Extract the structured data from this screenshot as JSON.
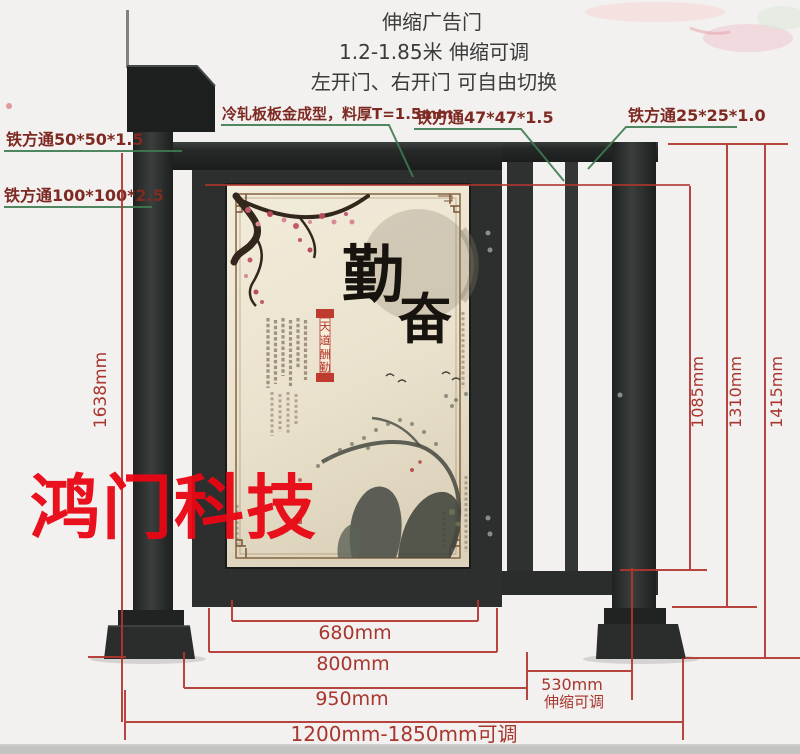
{
  "title": {
    "line1": "伸缩广告门",
    "line2": "1.2-1.85米 伸缩可调",
    "line3": "左开门、右开门 可自由切换"
  },
  "callouts": {
    "tube_50": "铁方通50*50*1.5",
    "tube_100": "铁方通100*100*2.5",
    "cold_rolled_plate": "冷轧板板金成型，料厚T=1.5mm",
    "tube_47": "铁方通47*47*1.5",
    "tube_25": "铁方通25*25*1.0"
  },
  "dimensions": {
    "post_height": "1638mm",
    "door_opening_height": "1085mm",
    "frame_height": "1310mm",
    "overall_height": "1415mm",
    "poster_width": "680mm",
    "door_width": "800mm",
    "door_section_width": "950mm",
    "telescopic_width": "530mm",
    "telescopic_note": "伸缩可调",
    "overall_width": "1200mm-1850mm可调"
  },
  "watermark": "鸿门科技",
  "poster": {
    "char_top": "勤",
    "char_bottom": "奋",
    "seal_chars": [
      "天",
      "道",
      "酬",
      "勤"
    ]
  },
  "colors": {
    "dimension_red": "#b2362f",
    "callout_green": "#3e7b51",
    "callout_text": "#7e2a23",
    "watermark_red": "#e90613",
    "frame_dark": "#272a29",
    "poster_beige": "#ece4d0"
  }
}
